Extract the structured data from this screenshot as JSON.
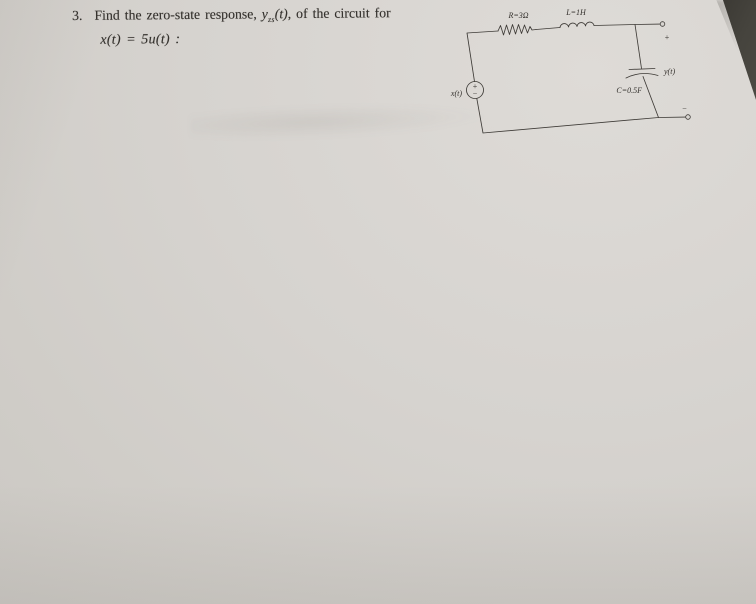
{
  "problem": {
    "number": "3.",
    "line1_prefix": "Find the zero-state response, ",
    "y_symbol": "y",
    "y_subscript": "zs",
    "y_args": "(t)",
    "line1_suffix": ", of the circuit for",
    "line2": "x(t) = 5u(t) :"
  },
  "circuit": {
    "resistor_label": "R=3Ω",
    "inductor_label": "L=1H",
    "capacitor_label": "C=0.5F",
    "source_label": "x(t)",
    "source_plus": "+",
    "source_minus": "−",
    "output_label": "y(t)",
    "terminal_plus": "+",
    "terminal_minus": "−"
  },
  "colors": {
    "paper": "#d5d2ce",
    "desk": "#44423c",
    "ink": "#34312d"
  }
}
